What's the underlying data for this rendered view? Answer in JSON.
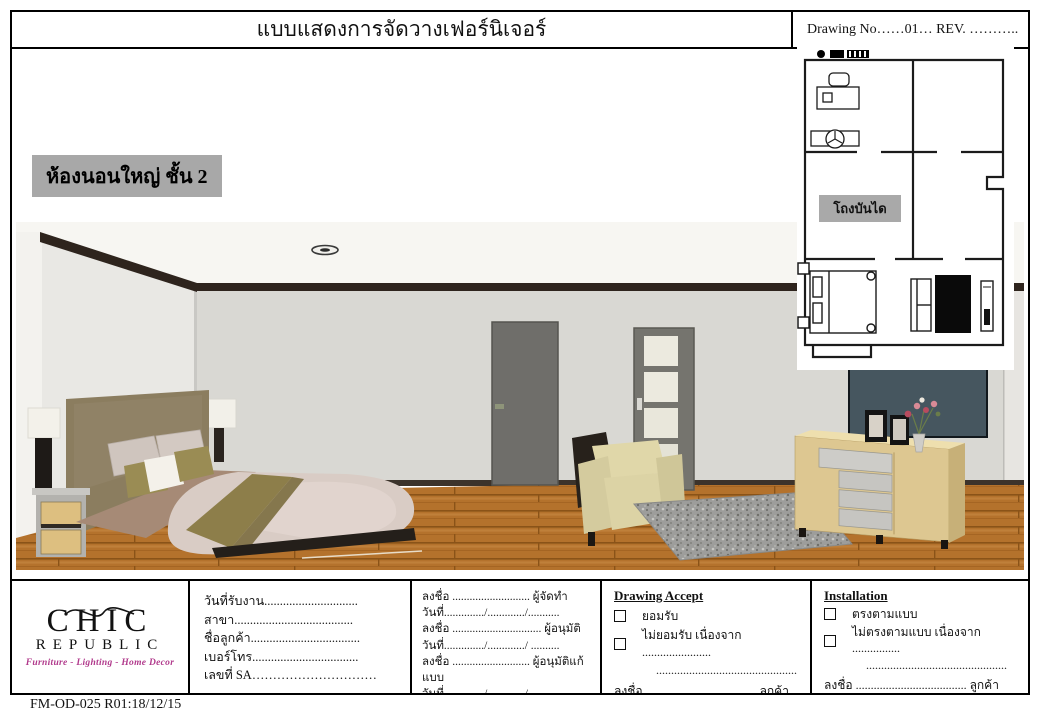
{
  "header": {
    "title": "แบบแสดงการจัดวางเฟอร์นิเจอร์",
    "drawing_no_label": "Drawing No……01…  REV. ……….."
  },
  "room_label": "ห้องนอนใหญ่ ชั้น 2",
  "floor_plan": {
    "stair_hall_label": "โถงบันได"
  },
  "title_block": {
    "logo": {
      "brand_top": "CHIC",
      "brand_bottom": "REPUBLIC",
      "tagline": "Furniture - Lighting - Home Decor"
    },
    "customer_info": {
      "rows": [
        "วันที่รับงาน..............................",
        "สาขา......................................",
        "ชื่อลูกค้า...................................",
        "เบอร์โทร..................................",
        "เลขที่ SA…………………………"
      ]
    },
    "signatures": {
      "rows": [
        "ลงชื่อ ........................... ผู้จัดทำ",
        "วันที่............../............./...........",
        "ลงชื่อ ............................... ผู้อนุมัติ",
        "วันที่............../............./ ..........",
        "ลงชื่อ ........................... ผู้อนุมัติแก้แบบ",
        "วันที่............../............./ .........."
      ]
    },
    "drawing_accept": {
      "heading": "Drawing Accept",
      "option_accept": "ยอมรับ",
      "option_reject": "ไม่ยอมรับ เนื่องจาก .......................",
      "filler_line": "...............................................",
      "sign_line": "ลงชื่อ ..................................... ลูกค้า"
    },
    "installation": {
      "heading": "Installation",
      "option_match": "ตรงตามแบบ",
      "option_mismatch": "ไม่ตรงตามแบบ  เนื่องจาก ................",
      "filler_line": "...............................................",
      "sign_customer": "ลงชื่อ ..................................... ลูกค้า",
      "sign_technician": "ลงชื่อ .....................................ช่างติดตั้ง"
    }
  },
  "footer": {
    "form_code": "FM-OD-025 R01:18/12/15"
  },
  "colors": {
    "tagline": "#b13a8c",
    "room_label_bg": "#a8a8a8",
    "plan_label_bg": "#a9a9a9",
    "wall": "#d9d8d3",
    "wood_floor": "#b4722c",
    "crown_molding": "#2e241d",
    "bed_accent_olive": "#8e7f4b",
    "tv_screen": "#46565f"
  }
}
